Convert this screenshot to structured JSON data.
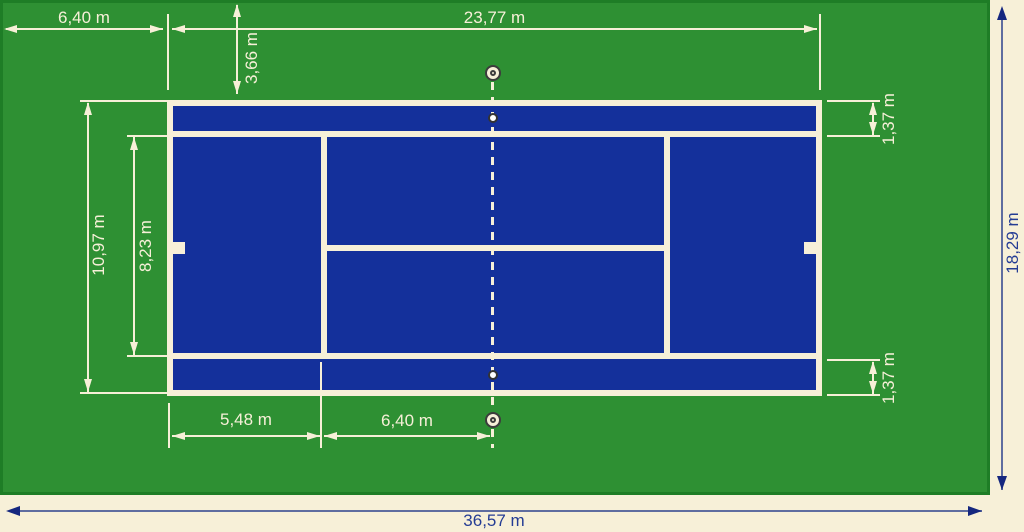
{
  "diagram": {
    "subject": "tennis-court-dimensions",
    "labels": {
      "side_runoff": "6,40 m",
      "court_length": "23,77 m",
      "back_runoff": "3,66 m",
      "alley_top": "1,37 m",
      "doubles_width": "10,97 m",
      "singles_width": "8,23 m",
      "alley_bottom": "1,37 m",
      "baseline_to_serviceline": "5,48 m",
      "serviceline_to_net": "6,40 m",
      "total_width": "18,29 m",
      "total_length": "36,57 m"
    },
    "icons": {
      "net_post": "double-circle",
      "singles_stick": "dot"
    },
    "colors": {
      "apron_green": "#2e9033",
      "apron_border": "#1e7d26",
      "court_blue": "#14309b",
      "line_cream": "#f7f0d8",
      "dim_navy_text": "#243c94",
      "dim_navy_line": "#5f6da0",
      "dim_navy_head": "#15277f",
      "post_outline": "#3c3c3c"
    }
  }
}
